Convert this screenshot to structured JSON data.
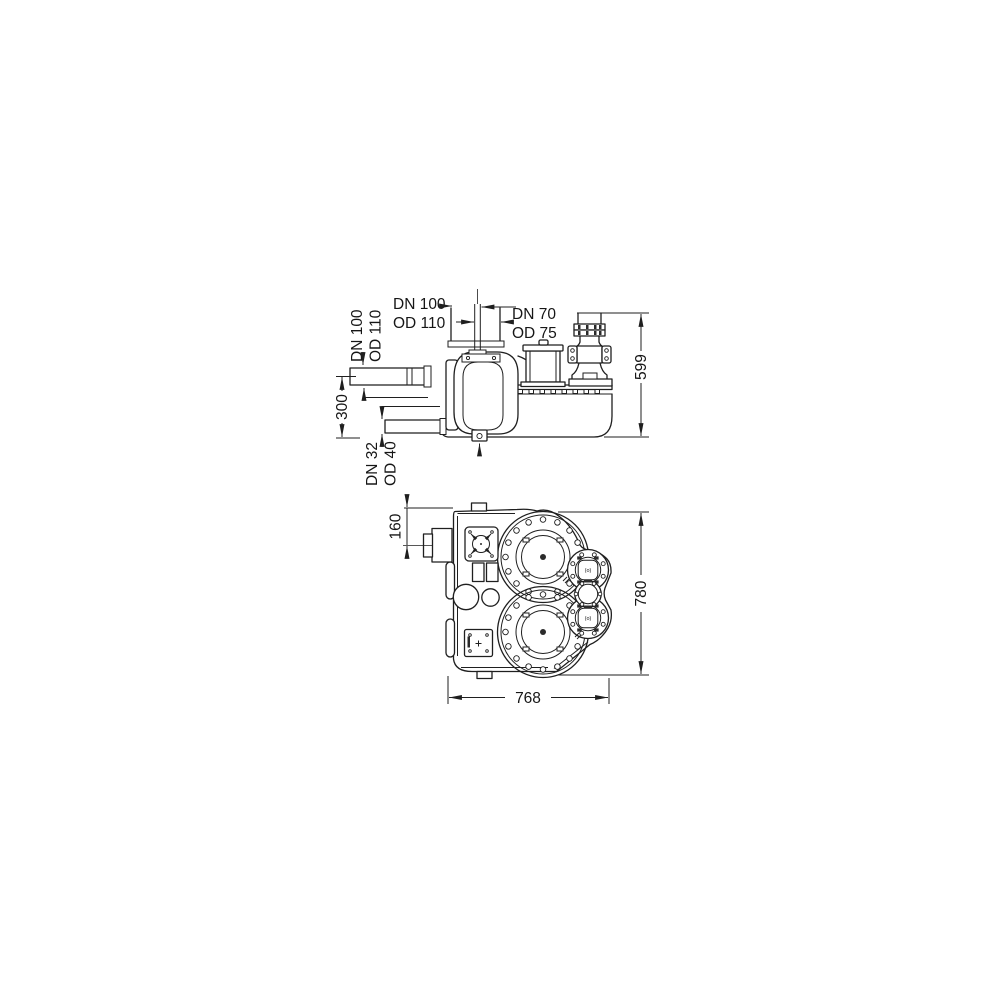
{
  "drawing_type": "technical-dimension-drawing",
  "side_view": {
    "top_inlet_label": {
      "line1": "DN 100",
      "line2": "OD 110"
    },
    "vent_label": {
      "line1": "DN 70",
      "line2": "OD 75"
    },
    "left_inlet_label": {
      "line1": "DN 100",
      "line2": "OD 110"
    },
    "bottom_outlet_label": {
      "line1": "DN 32",
      "line2": "OD 40"
    },
    "total_height": "599",
    "inlet_height": "300"
  },
  "plan_view": {
    "stub_offset": "160",
    "total_depth": "780",
    "total_width": "768",
    "pump_cover_mark": "(o)"
  },
  "colors": {
    "line": "#1f1f1f",
    "background": "#ffffff",
    "text": "#161616"
  }
}
